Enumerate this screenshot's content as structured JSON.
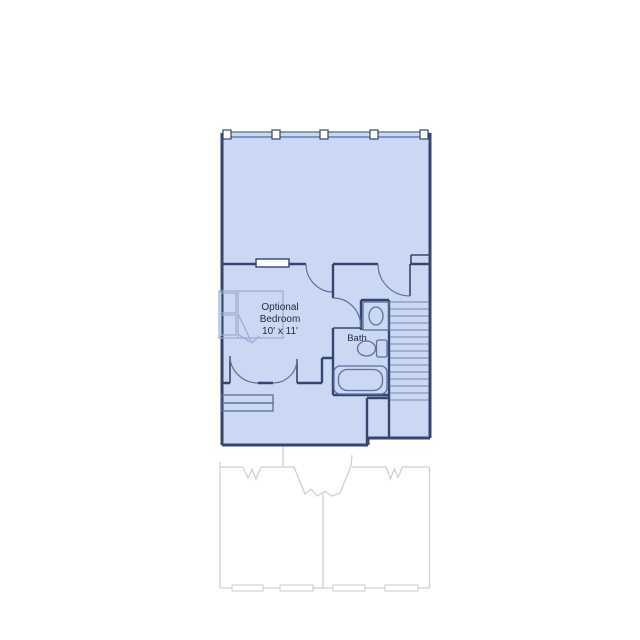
{
  "floorplan": {
    "type": "residential floor plan, upper level with loft, optional bedroom, bath and staircase over a faint lower-level outline",
    "rooms": [
      {
        "name_line1": "Optional",
        "name_line2": "Bedroom",
        "dimensions": "10' x 11'"
      },
      {
        "name": "Bath"
      }
    ],
    "features": [
      "railing-with-posts",
      "window",
      "bed",
      "sink",
      "toilet",
      "bathtub",
      "staircase",
      "lower-level-break-lines",
      "lower-level-windows"
    ]
  },
  "colors": {
    "background": "#ffffff",
    "floor_fill": "#cbd8f3",
    "wall_stroke": "#36456f",
    "fixture_stroke": "#5d6f9f",
    "furniture_stroke": "#9aabd2",
    "stair_stroke": "#7486ae",
    "label_text": "#252b3d",
    "lower_level_stroke": "#d0d0d0"
  }
}
